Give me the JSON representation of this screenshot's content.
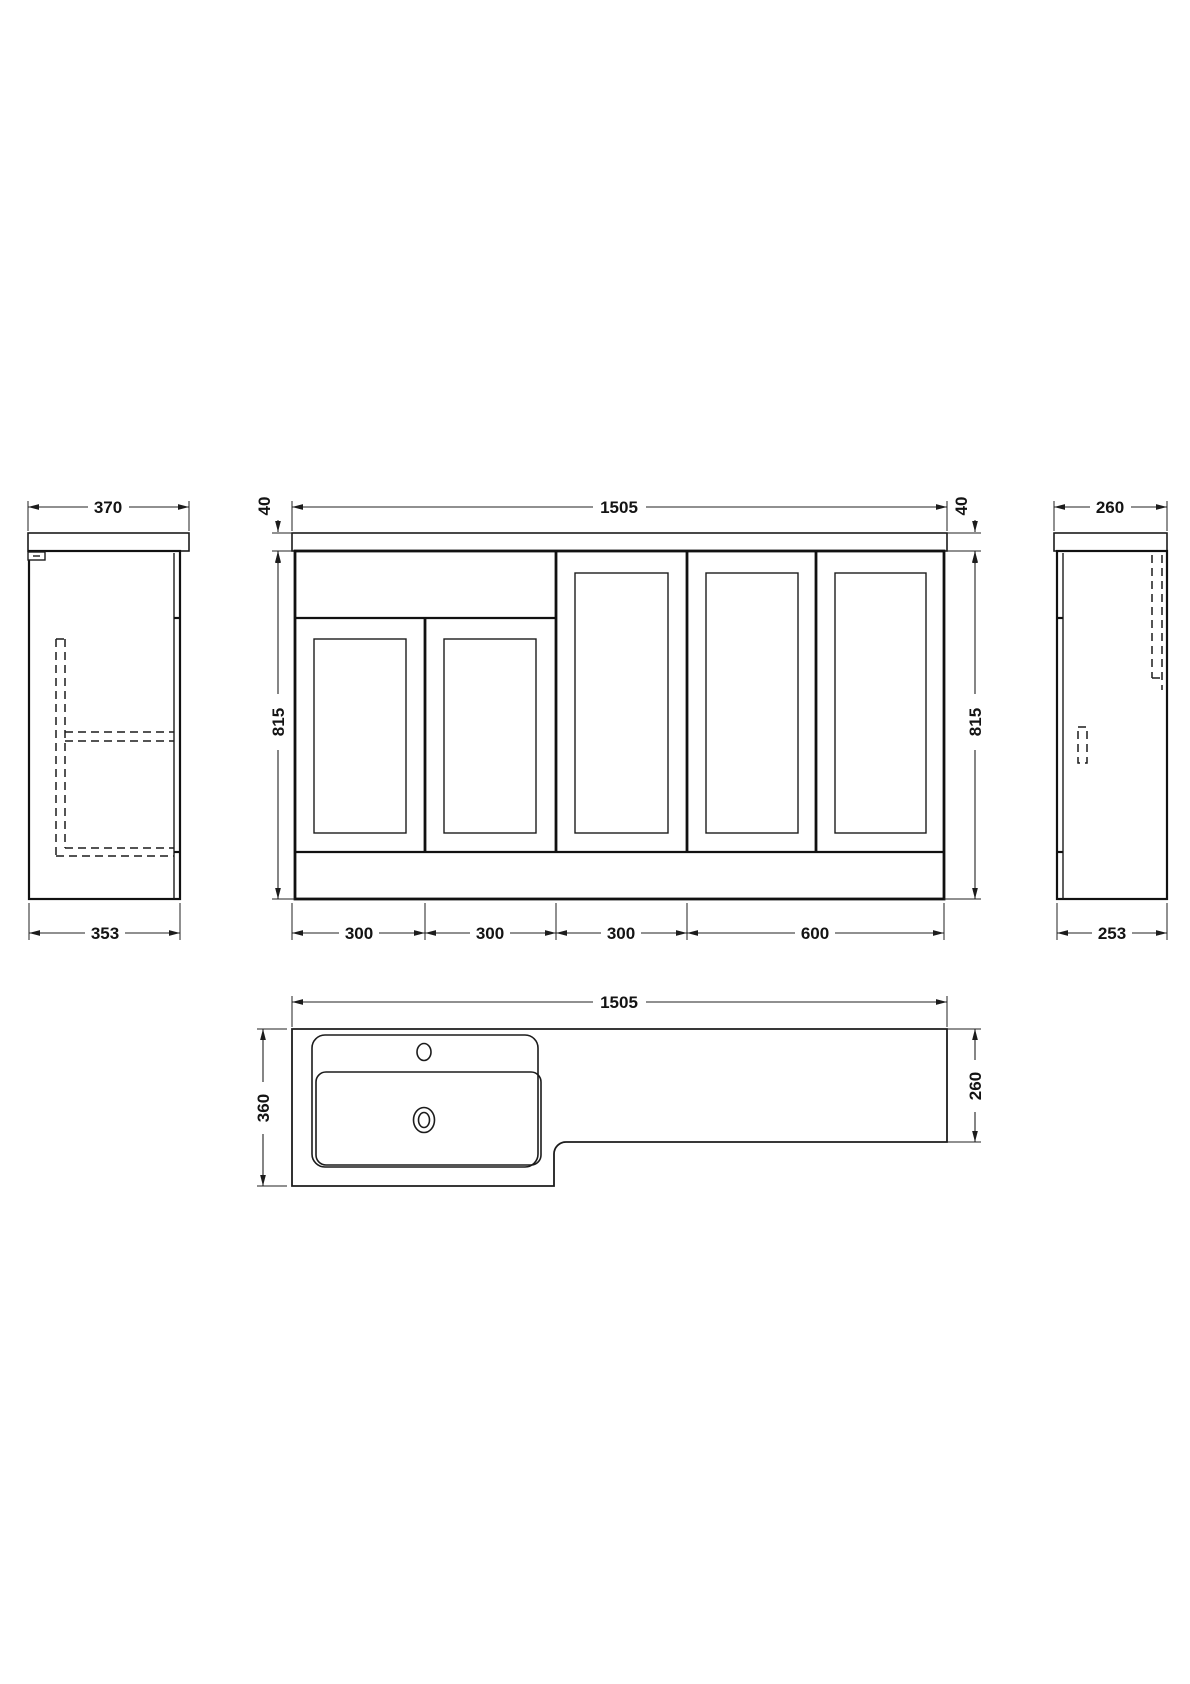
{
  "views": {
    "left_side": {
      "width": "370",
      "depth": "353"
    },
    "front": {
      "width": "1505",
      "top_thickness_left": "40",
      "top_thickness_right": "40",
      "height_left": "815",
      "height_right": "815",
      "modules": [
        "300",
        "300",
        "300",
        "600"
      ]
    },
    "right_side": {
      "width": "260",
      "depth": "253"
    },
    "plan": {
      "width": "1505",
      "depth_left": "360",
      "depth_right": "260"
    }
  }
}
